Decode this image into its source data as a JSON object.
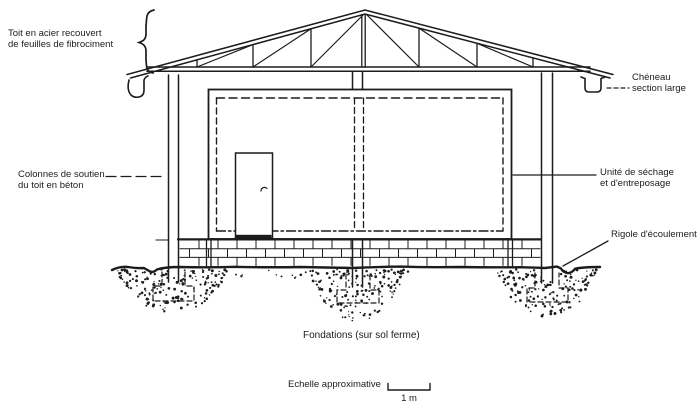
{
  "diagram": {
    "labels": {
      "roof": {
        "line1": "Toit en acier recouvert",
        "line2": "de feuilles de fibrociment"
      },
      "gutter": {
        "line1": "Chéneau",
        "line2": "section large"
      },
      "columns": {
        "line1": "Colonnes de soutien",
        "line2": "du toit en béton"
      },
      "unit": {
        "line1": "Unité de séchage",
        "line2": "et d'entreposage"
      },
      "drain": {
        "text": "Rigole d'écoulement"
      },
      "foundations": {
        "text": "Fondations (sur sol ferme)"
      },
      "scale": {
        "caption": "Echelle approximative",
        "value": "1 m"
      }
    },
    "colors": {
      "ink": "#1c1c1c",
      "background": "#ffffff"
    }
  }
}
